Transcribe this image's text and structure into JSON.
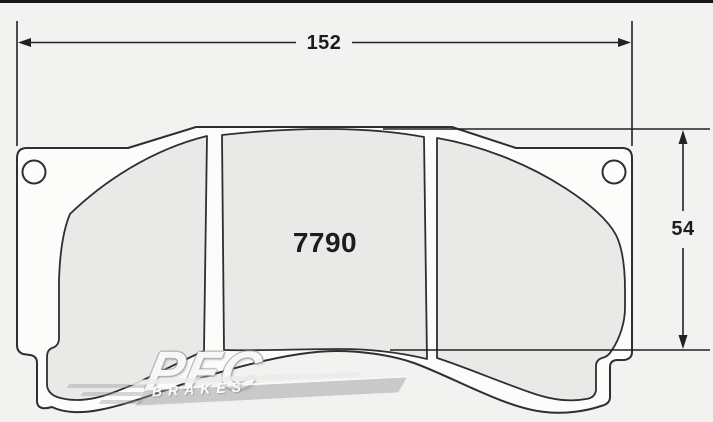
{
  "drawing": {
    "part_number": "7790",
    "dimensions": {
      "width": "152",
      "height": "54"
    },
    "watermark": {
      "brand": "PFC",
      "sub": "BRAKES"
    },
    "colors": {
      "background": "#f2f2f0",
      "top_bar": "#171717",
      "outline": "#2f2f2f",
      "dimension_line": "#222222",
      "plate_fill": "#fcfcfb",
      "friction_fill": "#e9e9e7",
      "text": "#1d1d1d"
    }
  }
}
